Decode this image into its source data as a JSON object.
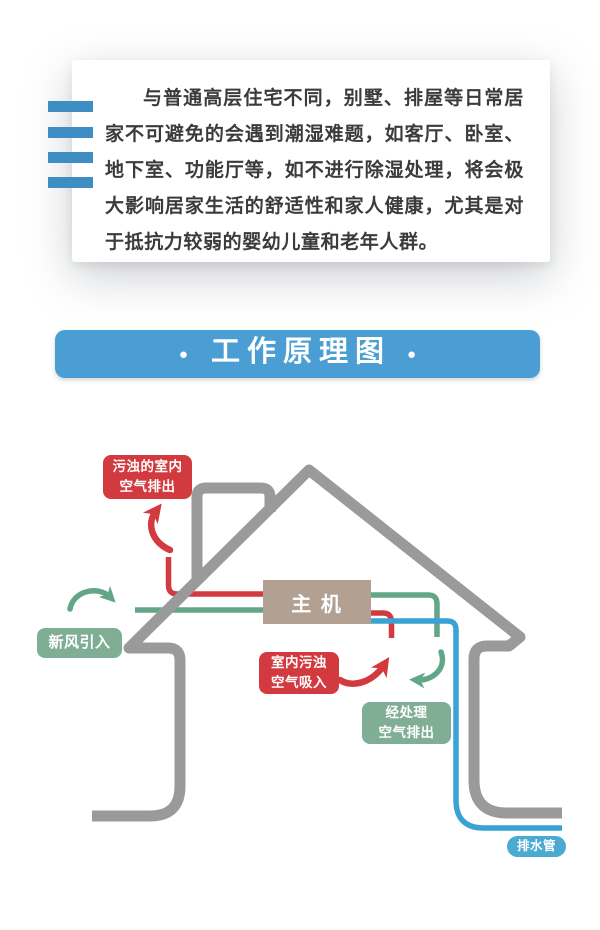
{
  "theme": {
    "page-bg": "#ffffff",
    "red": "#d23a40",
    "green": "#63a687",
    "green-label": "#7fae95",
    "blue": "#39a3d6",
    "blue-label": "#4aaad2",
    "gray": "#9a9a9a",
    "taupe": "#b2a193",
    "banner-blue": "#4a9ed3",
    "bar-blue": "#3e8ec4",
    "text": "#3b3b3b"
  },
  "intro_card": {
    "paragraph": "与普通高层住宅不同，别墅、排屋等日常居家不可避免的会遇到潮湿难题，如客厅、卧室、地下室、功能厅等，如不进行除湿处理，将会极大影响居家生活的舒适性和家人健康，尤其是对于抵抗力较弱的婴幼儿童和老年人群。"
  },
  "banner": {
    "bullet": "●",
    "title": "工作原理图"
  },
  "diagram": {
    "main_unit": "主 机",
    "labels": {
      "dirty_air_out": {
        "line1": "污浊的室内",
        "line2": "空气排出"
      },
      "fresh_air_in": {
        "line1": "新风引入"
      },
      "indoor_air_suction": {
        "line1": "室内污浊",
        "line2": "空气吸入"
      },
      "treated_air_out": {
        "line1": "经处理",
        "line2": "空气排出"
      },
      "drain_pipe": {
        "line1": "排水管"
      }
    }
  }
}
